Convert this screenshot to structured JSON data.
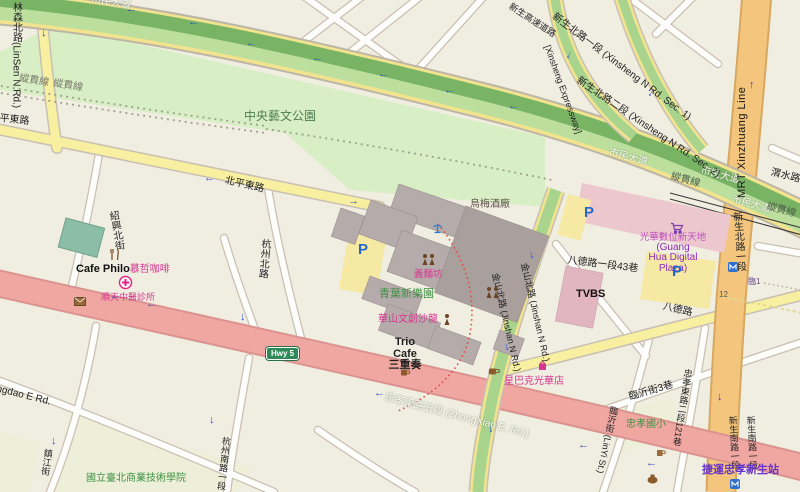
{
  "colors": {
    "park_green": "#d8efc5",
    "band_dark_green": "#79b465",
    "band_light_green": "#bcdf9e",
    "road_yellow": "#f8f0a0",
    "hwy_pink": "#f0a7a1",
    "mrt_orange": "#f3c57d",
    "poi_pink": "#d6368f",
    "label_green": "#3d9141",
    "arrow_blue": "#2b4fd8",
    "hwy_shield_green": "#2e8b57"
  },
  "icons": {
    "arrow_left": "←",
    "arrow_right": "→",
    "arrow_up": "↑",
    "arrow_down": "↓"
  },
  "roads": {
    "linsen": "林森北路(LinSen N Rd.)",
    "beiping": "北平東路",
    "hangzhou_n": "杭州北路",
    "shaoxing_n": "紹興北街",
    "civic_blvd": "市民大道",
    "rail_line": "縱貫線",
    "weishui": "渭水路",
    "xinsheng_expwy_cjk": "新生高速道路",
    "xinsheng_expwy_en": "[Xinsheng Expressway]",
    "xinsheng_n_sec1": "新生北路一段 (Xinsheng N Rd. Sec. 1)",
    "xinsheng_n_sec2": "新生北路二段 (Xinsheng N Rd. Sec. 2)",
    "mrt_line": "MRT Xinzhuang Line",
    "xinsheng_n1": "新生北路一段",
    "xinsheng_s1": "新生南路一段",
    "bade": "八德路",
    "bade_lane43": "八德路一段43巷",
    "lane_lin1": "臨1",
    "lane_12": "12",
    "jinshan": "金山北路 (Jinshan N Rd.)",
    "zhongxiao": "忠孝東路五段 (ZhongXiao E. Rd.)",
    "zhongxiao_lane121": "忠孝東路二段121巷",
    "linyi": "臨沂街 (LinYi St.)",
    "linyi_lane3": "臨沂街3巷",
    "qingdao": "Qingdao E Rd.",
    "zhenjiang": "鎮江街",
    "hangzhou_s1": "杭州南路一段",
    "hwy5": "Hwy 5"
  },
  "places": {
    "park": "中央藝文公園",
    "umay_winery": "烏梅酒廠",
    "yimianfang": "義麵坊",
    "qingye": "青葉新樂園",
    "huashan_salon": "華山文創沙龍",
    "trio_line1": "Trio",
    "trio_line2": "Cafe",
    "trio_line3": "三重奏",
    "starbucks": "星巴克光華店",
    "tvbs": "TVBS",
    "guanghua_cjk": "光華數位新天地",
    "guanghua_en1": "(Guang",
    "guanghua_en2": "Hua Digital",
    "guanghua_en3": "Plaza)",
    "cafe_philo_en": "Cafe Philo",
    "cafe_philo_cjk": "慕哲咖啡",
    "clinic": "順天中醫診所",
    "ntub": "國立臺北商業技術學院",
    "zhongxiao_elementary": "忠孝國小",
    "mrt_station": "捷運忠孝新生站",
    "parking": "P"
  }
}
